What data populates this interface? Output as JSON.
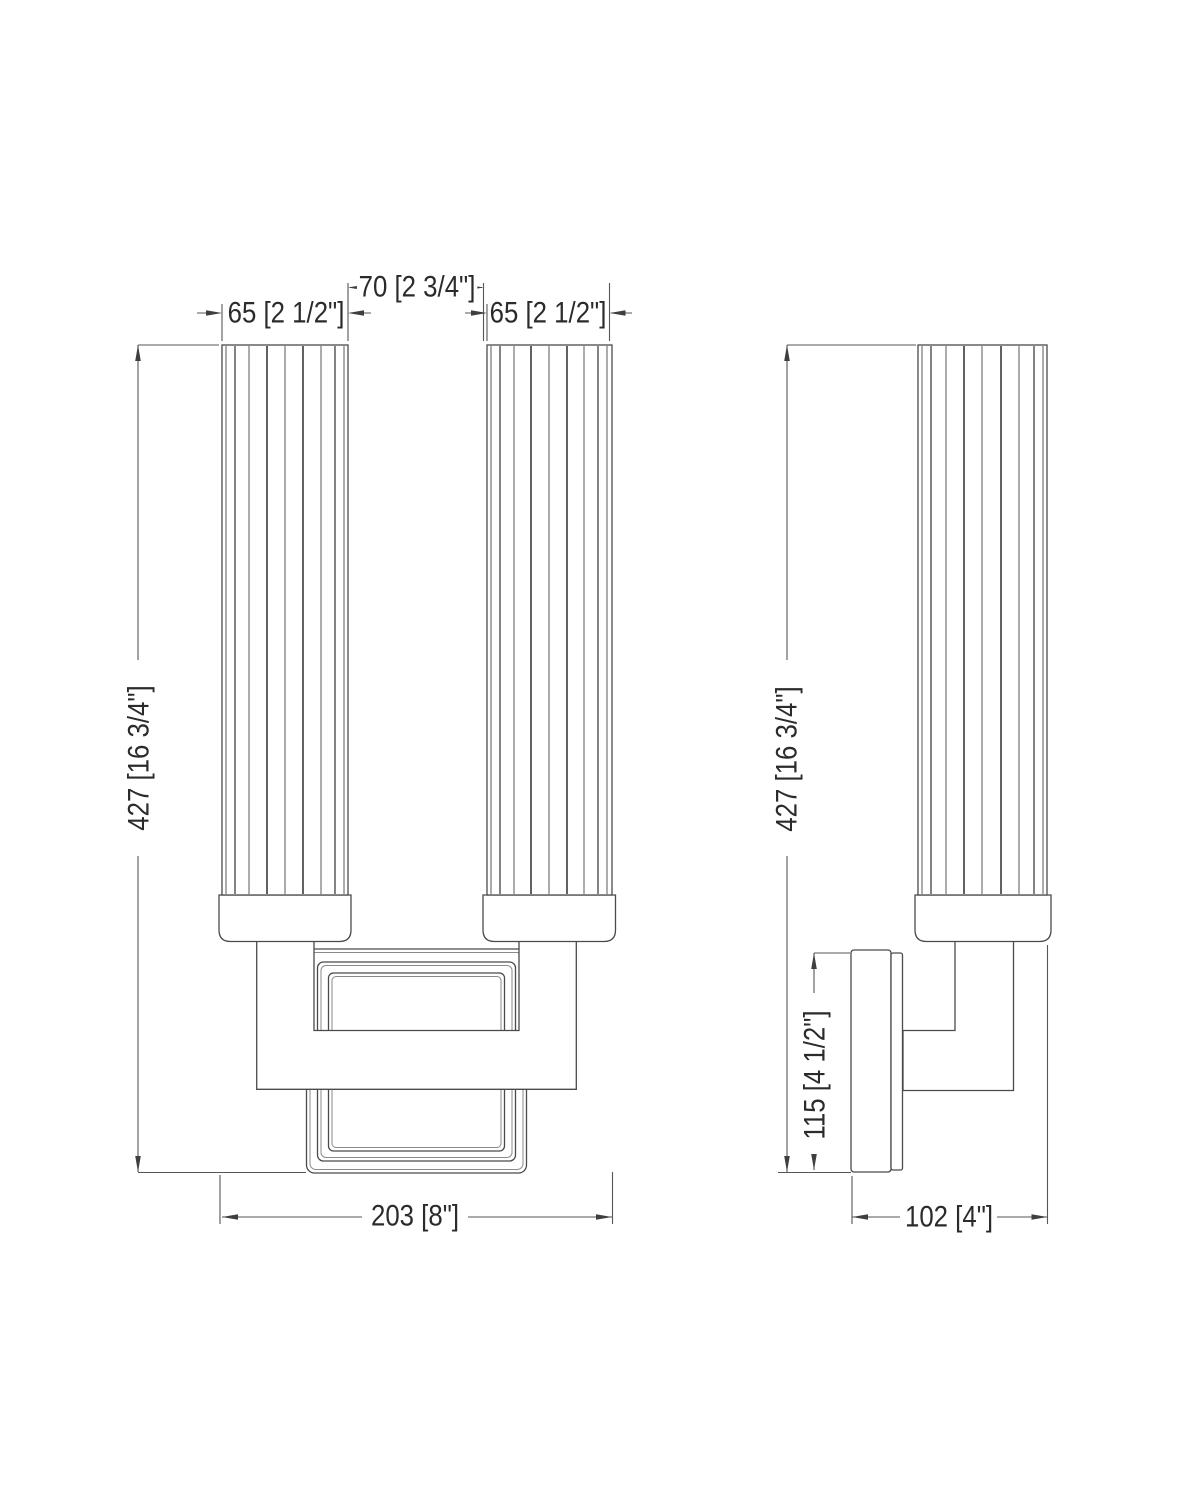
{
  "page": {
    "background": "#ffffff"
  },
  "drawing": {
    "line_color": "#4a4a4a",
    "inner_line_color": "#8a8a8a",
    "dim_color": "#565656",
    "text_color": "#2b2b2b"
  },
  "dims": {
    "shade_width_left": "65 [2 1/2\"]",
    "shade_gap": "70 [2 3/4\"]",
    "shade_width_right": "65 [2 1/2\"]",
    "front_height": "427 [16 3/4\"]",
    "front_width": "203 [8\"]",
    "side_height": "427 [16 3/4\"]",
    "backplate_height": "115 [4 1/2\"]",
    "fixture_depth": "102 [4\"]"
  }
}
